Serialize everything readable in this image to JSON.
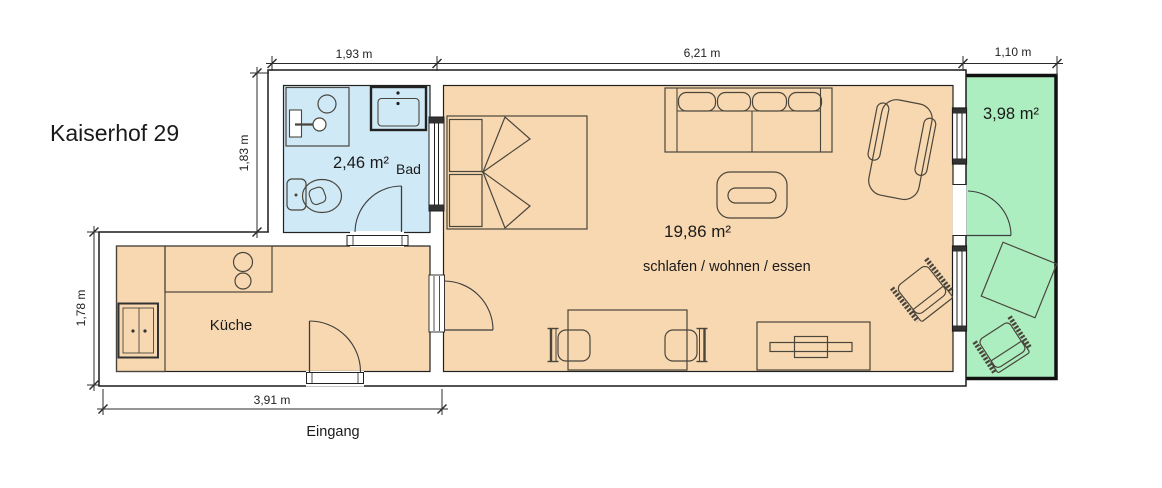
{
  "title": "Kaiserhof 29",
  "colors": {
    "room": "#f8d8b1",
    "bath": "#cfe9f6",
    "balcony": "#aceec0",
    "wall_fill": "#ffffff",
    "wall_line": "#1a1a1a",
    "furniture_line": "#4a463c"
  },
  "rooms": {
    "bath": {
      "area": "2,46 m²",
      "label": "Bad"
    },
    "kitchen": {
      "label": "Küche"
    },
    "living": {
      "area": "19,86 m²",
      "label": "schlafen / wohnen / essen"
    },
    "balcony": {
      "area": "3,98 m²"
    }
  },
  "dimensions": {
    "top_bath": "1,93 m",
    "top_living": "6,21 m",
    "top_balcony": "1,10 m",
    "left_bath": "1,83 m",
    "left_kitchen": "1,78 m",
    "bottom_kitchen": "3,91 m"
  },
  "entrance_label": "Eingang"
}
